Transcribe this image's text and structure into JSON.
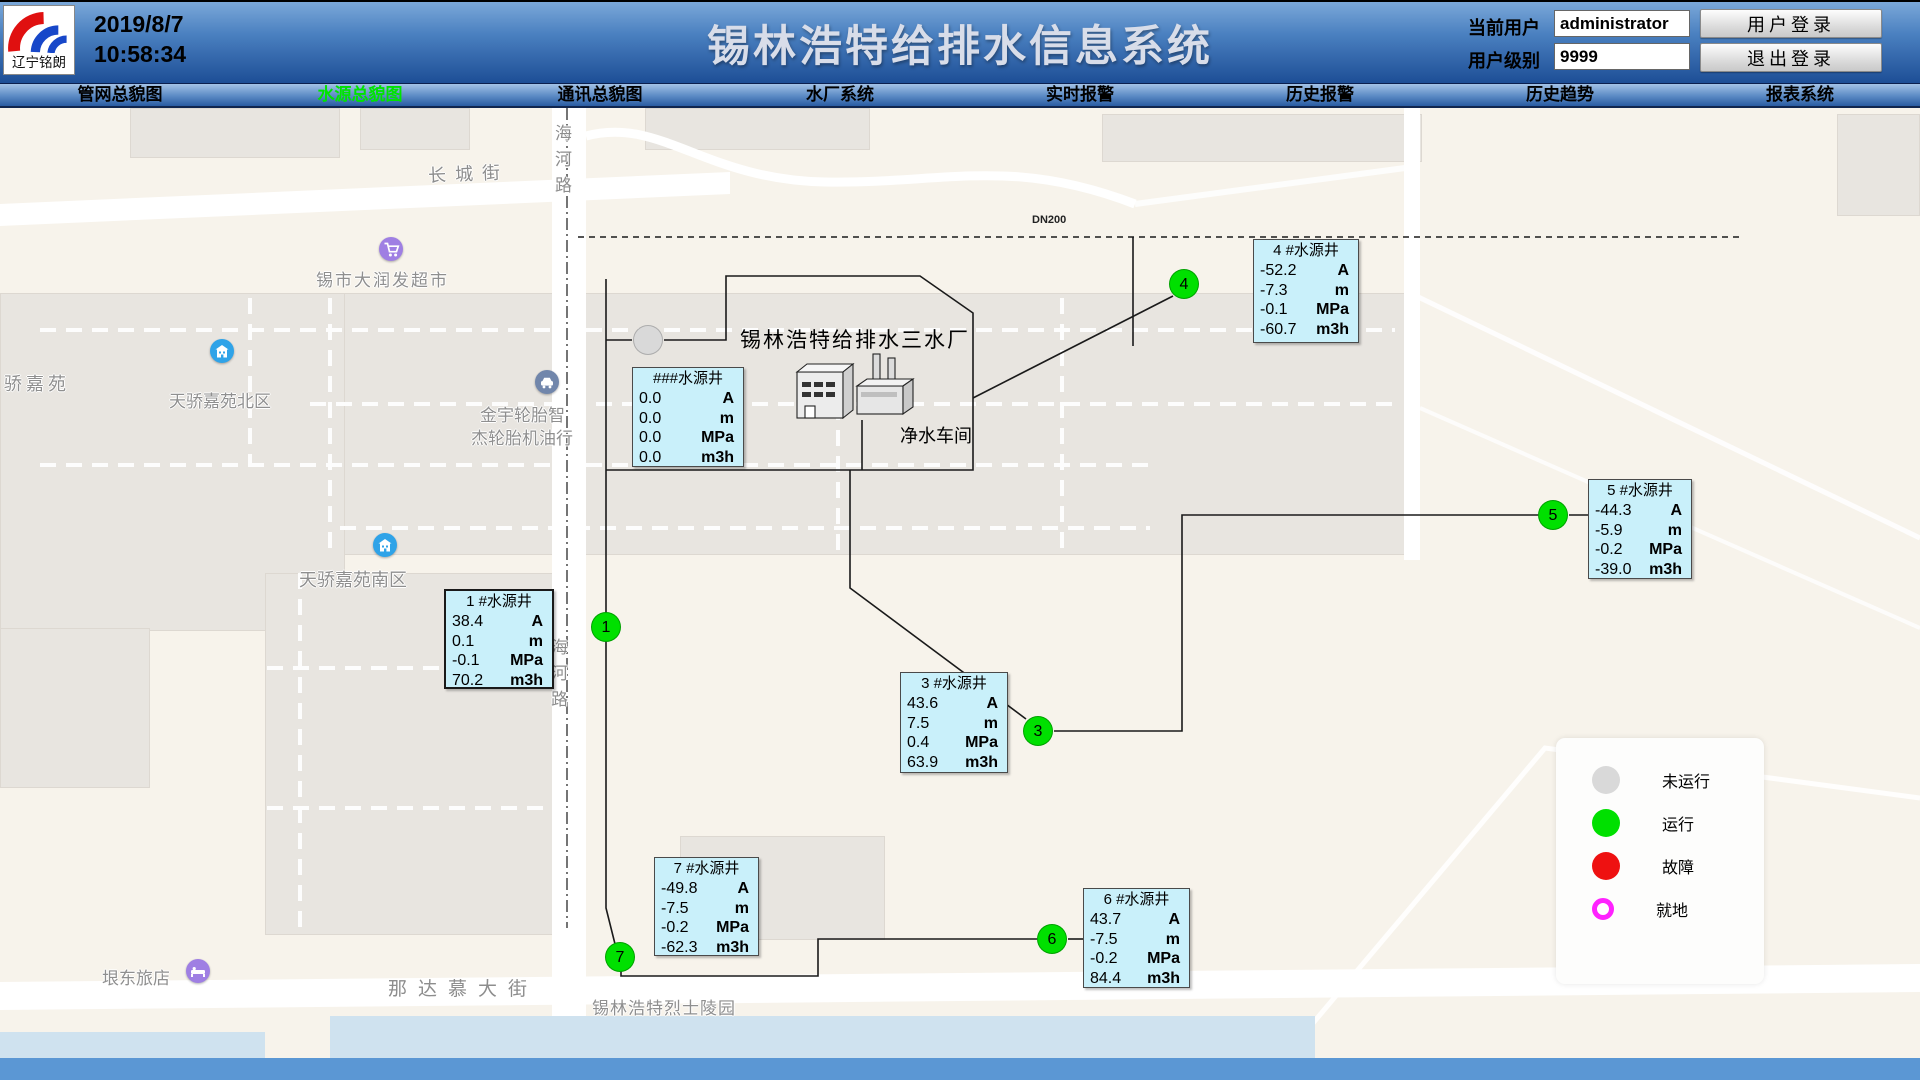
{
  "header": {
    "logo_text": "辽宁铭朗",
    "date": "2019/8/7",
    "time": "10:58:34",
    "title": "锡林浩特给排水信息系统",
    "current_user_label": "当前用户",
    "current_user_value": "administrator",
    "user_level_label": "用户级别",
    "user_level_value": "9999",
    "login_button": "用户登录",
    "logout_button": "退出登录"
  },
  "nav": {
    "active_color": "#00e400",
    "tabs": [
      {
        "label": "管网总貌图",
        "active": false
      },
      {
        "label": "水源总貌图",
        "active": true
      },
      {
        "label": "通讯总貌图",
        "active": false
      },
      {
        "label": "水厂系统",
        "active": false
      },
      {
        "label": "实时报警",
        "active": false
      },
      {
        "label": "历史报警",
        "active": false
      },
      {
        "label": "历史趋势",
        "active": false
      },
      {
        "label": "报表系统",
        "active": false
      }
    ]
  },
  "map": {
    "plant_title": "锡林浩特给排水三水厂",
    "workshop_label": "净水车间",
    "pipe_label": "DN200",
    "streets": {
      "changcheng": "长城街",
      "nadamu": "那达慕大街",
      "haihe": "海河路"
    },
    "pois": [
      {
        "name": "锡市大润发超市",
        "icon": "cart-icon",
        "icon_color": "#9f7fe3"
      },
      {
        "name": "天骄嘉苑",
        "icon": null,
        "icon_color": null
      },
      {
        "name": "天骄嘉苑北区",
        "icon": "building-icon",
        "icon_color": "#2fa3e8"
      },
      {
        "name": "金宇轮胎智",
        "name2": "杰轮胎机油行",
        "icon": "car-icon",
        "icon_color": "#7186ab"
      },
      {
        "name": "天骄嘉苑南区",
        "icon": "building-icon",
        "icon_color": "#2fa3e8"
      },
      {
        "name": "垠东旅店",
        "icon": "bed-icon",
        "icon_color": "#9f7fe3"
      },
      {
        "name": "锡林浩特烈士陵园",
        "icon": null,
        "icon_color": null
      }
    ],
    "units": {
      "current": "A",
      "level": "m",
      "pressure": "MPa",
      "flow": "m3h"
    },
    "status_colors": {
      "not_running": "#d9d9d9",
      "running": "#00e000",
      "fault": "#ee1111",
      "local": "#ff22ff"
    },
    "box_bg": "#c9f0fa",
    "wells": [
      {
        "id": "",
        "title": "###水源井",
        "current": "0.0",
        "level": "0.0",
        "pressure": "0.0",
        "flow": "0.0",
        "status": "not_running"
      },
      {
        "id": "1",
        "title": "1  #水源井",
        "current": "38.4",
        "level": "0.1",
        "pressure": "-0.1",
        "flow": "70.2",
        "status": "running"
      },
      {
        "id": "3",
        "title": "3  #水源井",
        "current": "43.6",
        "level": "7.5",
        "pressure": "0.4",
        "flow": "63.9",
        "status": "running"
      },
      {
        "id": "4",
        "title": "4  #水源井",
        "current": "-52.2",
        "level": "-7.3",
        "pressure": "-0.1",
        "flow": "-60.7",
        "status": "running"
      },
      {
        "id": "5",
        "title": "5  #水源井",
        "current": "-44.3",
        "level": "-5.9",
        "pressure": "-0.2",
        "flow": "-39.0",
        "status": "running"
      },
      {
        "id": "6",
        "title": "6  #水源井",
        "current": "43.7",
        "level": "-7.5",
        "pressure": "-0.2",
        "flow": "84.4",
        "status": "running"
      },
      {
        "id": "7",
        "title": "7  #水源井",
        "current": "-49.8",
        "level": "-7.5",
        "pressure": "-0.2",
        "flow": "-62.3",
        "status": "running"
      }
    ],
    "legend": {
      "items": [
        {
          "label": "未运行",
          "status": "not_running"
        },
        {
          "label": "运行",
          "status": "running"
        },
        {
          "label": "故障",
          "status": "fault"
        },
        {
          "label": "就地",
          "status": "local"
        }
      ]
    }
  }
}
